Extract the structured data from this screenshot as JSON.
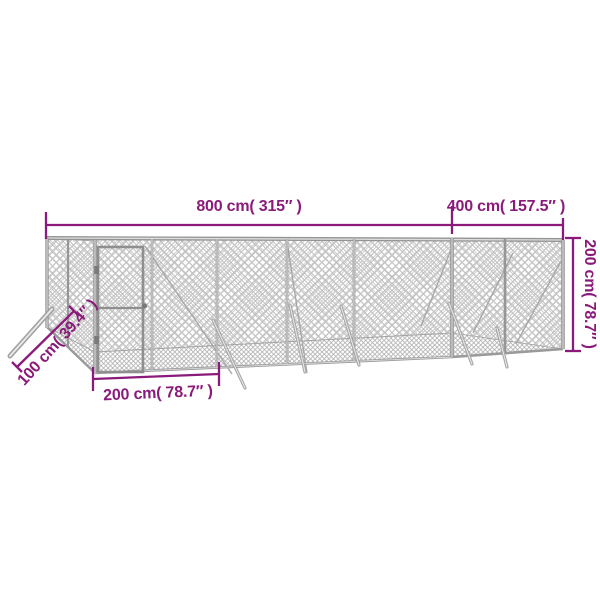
{
  "figure": {
    "description": "dimension diagram of outdoor chain-link dog kennel",
    "background_color": "#ffffff",
    "colors": {
      "dimension_accent": "#8a1b7a",
      "fence_frame": "#979797",
      "fence_mesh": "#b9b9b9",
      "fence_mesh_fine": "#acacac",
      "fence_highlight": "#e0e0e0"
    },
    "dimensions": {
      "width": {
        "label": "800 cm( 315″ )",
        "cm": 800,
        "inches": 315
      },
      "depth": {
        "label": "400 cm( 157.5″ )",
        "cm": 400,
        "inches": 157.5
      },
      "height": {
        "label": "200 cm( 78.7″ )",
        "cm": 200,
        "inches": 78.7
      },
      "panel": {
        "label": "200 cm( 78.7″ )",
        "cm": 200,
        "inches": 78.7
      },
      "strut": {
        "label": "100 cm( 39.4″ )",
        "cm": 100,
        "inches": 39.4
      }
    }
  }
}
